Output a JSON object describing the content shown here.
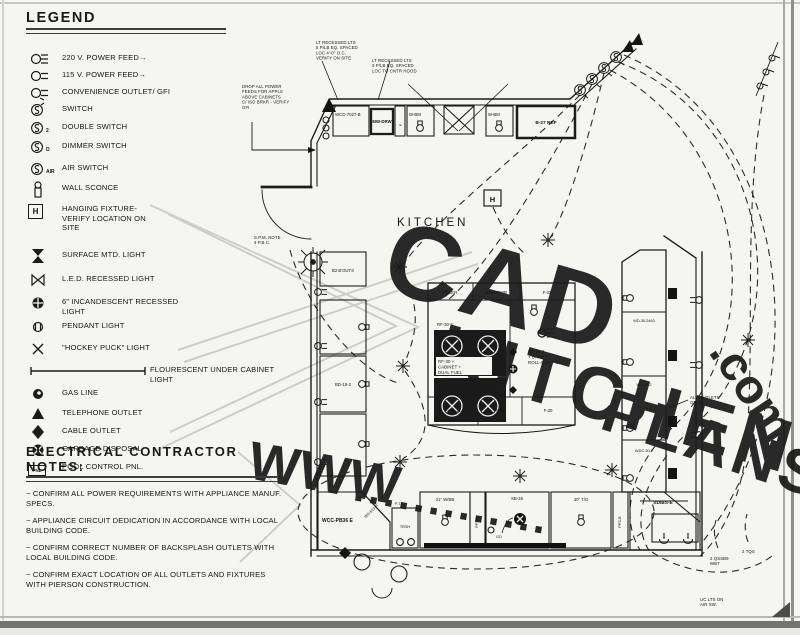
{
  "legend": {
    "title": "LEGEND",
    "items": [
      {
        "symbol": "outlet-220-icon",
        "label": "220 V. POWER FEED→",
        "sub": ""
      },
      {
        "symbol": "outlet-115-icon",
        "label": "115 V. POWER FEED→",
        "sub": ""
      },
      {
        "symbol": "gfi-outlet-icon",
        "label": "CONVENIENCE OUTLET/ GFI",
        "sub": ""
      },
      {
        "symbol": "switch-icon",
        "label": "SWITCH",
        "sub": ""
      },
      {
        "symbol": "double-switch-icon",
        "label": "DOUBLE SWITCH",
        "sub": "2"
      },
      {
        "symbol": "dimmer-switch-icon",
        "label": "DIMMER SWITCH",
        "sub": "D"
      },
      {
        "symbol": "air-switch-icon",
        "label": "AIR SWITCH",
        "sub": "AIR"
      },
      {
        "symbol": "wall-sconce-icon",
        "label": "WALL SCONCE",
        "sub": ""
      },
      {
        "symbol": "hanging-fixture-icon",
        "label": "HANGING FIXTURE- VERIFY LOCATION ON SITE",
        "sub": "H"
      },
      {
        "symbol": "surface-mtd-light-icon",
        "label": "SURFACE MTD. LIGHT",
        "sub": ""
      },
      {
        "symbol": "led-recessed-light-icon",
        "label": "L.E.D. RECESSED LIGHT",
        "sub": ""
      },
      {
        "symbol": "incandescent-recessed-light-icon",
        "label": "6\" INCANDESCENT RECESSED LIGHT",
        "sub": ""
      },
      {
        "symbol": "pendant-light-icon",
        "label": "PENDANT LIGHT",
        "sub": ""
      },
      {
        "symbol": "hockey-puck-light-icon",
        "label": "\"HOCKEY PUCK\" LIGHT",
        "sub": ""
      },
      {
        "symbol": "under-cabinet-light-icon",
        "label": "FLOURESCENT UNDER CABINET LIGHT",
        "sub": ""
      },
      {
        "symbol": "gas-line-icon",
        "label": "GAS LINE",
        "sub": ""
      },
      {
        "symbol": "telephone-outlet-icon",
        "label": "TELEPHONE OUTLET",
        "sub": ""
      },
      {
        "symbol": "cable-outlet-icon",
        "label": "CABLE OUTLET",
        "sub": ""
      },
      {
        "symbol": "garbage-disposal-icon",
        "label": "GARBAGE DISPOSAL",
        "sub": ""
      },
      {
        "symbol": "pool-control-icon",
        "label": "POOL CONTROL PNL.",
        "sub": "PNL"
      }
    ]
  },
  "notes": {
    "title": "ELECTRICAL CONTRACTOR NOTES:",
    "items": [
      "~ CONFIRM ALL POWER REQUIREMENTS WITH APPLIANCE MANUF. SPECS.",
      "~ APPLIANCE CIRCUIT DEDICATION IN ACCORDANCE WITH LOCAL BUILDING CODE.",
      "~ CONFIRM CORRECT NUMBER OF BACKSPLASH OUTLETS WITH LOCAL BUILDING CODE.",
      "~ CONFIRM EXACT LOCATION OF ALL OUTLETS AND FIXTURES WITH PIERSON CONSTRUCTION."
    ]
  },
  "plan": {
    "labels": {
      "kitchen": "KITCHEN",
      "htag": "H",
      "t1": "WCC-7027-B",
      "t2": "MW-DRW",
      "t3": "F",
      "t4": "W-BM",
      "t5": "W-BM",
      "fridge": "B-27 REF",
      "l1": "B2 B'OUTS",
      "l2": "BD-18-2",
      "bl_bold": "WCC-PB36 E",
      "bl_diag": "WS-613-R",
      "pts": "P-TS",
      "trash": "TRSH",
      "b1": "21\" W/BB",
      "b2": "PPS-B",
      "sink": "SB-36",
      "gd": "GD",
      "b3": "30\" T/O",
      "b4": "PPS-B",
      "br_bold": "SD/BS-E",
      "r1": "WD-30-2463",
      "r2": "WD-24-2",
      "r3": "WDC-30-2",
      "i1": "FILLER",
      "i2": "MW-DRWR",
      "i3": "F-33",
      "irf": "RF-30-2",
      "ib1": "FWC-12-7",
      "ib2": "F-30",
      "ib3": "F-30"
    },
    "annotations": {
      "top1": [
        "LT RECESSED LTS",
        "5 P/LB EQ. SPACED",
        "LOC 4'-0\" O.C.",
        "VERIFY ON SITE"
      ],
      "top2": [
        "LT RECESSED LTS",
        "3 P/LB EQ. SPACED",
        "LOC TO CNTR HOOD"
      ],
      "feed": [
        "DROP ALL POWER",
        "FEEDS FOR APPLS",
        "ABOVE CABINETS",
        "C/ ISO BRKR - VERIFY",
        "GFI"
      ],
      "door": [
        "S.P.M. NOTE",
        "4 P.B.C."
      ],
      "island_ct": [
        "RF-30 +",
        "CABINET +",
        "DUAL FUEL"
      ],
      "island_r": [
        "RF-24-2",
        "+ BASE +",
        "ROLL-OUT PNL"
      ],
      "right": [
        "ALL OUTLETS",
        "GFI B."
      ],
      "br1": [
        "2 QSSB9",
        "WBT"
      ],
      "br2": [
        "2 TQS"
      ],
      "bot": [
        "UC LTS ON",
        "AIR SW."
      ]
    }
  },
  "watermark": {
    "word1": "CAD",
    "word2": "KITCHEN",
    "word3": "PLANS",
    "web": "WWW",
    "dots": ".............",
    "domain": ".com",
    "color": "#c9c9c6"
  },
  "colors": {
    "line": "#1c1c1c",
    "paper": "#f5f5f2",
    "frame_dark": "#737370"
  }
}
